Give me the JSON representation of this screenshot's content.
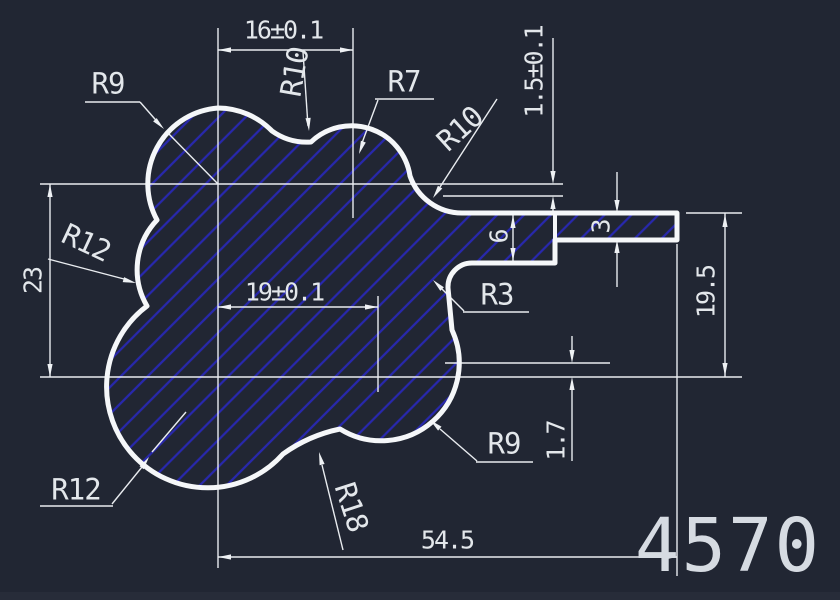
{
  "drawing": {
    "background_color": "#212633",
    "outline_color": "#f5f7f9",
    "dimension_line_color": "#e9ecf0",
    "hatch_color": "#2828ad",
    "text_color": "#e3e7eb"
  },
  "labels": {
    "dim_16": {
      "text": "16±0.1"
    },
    "r10_top": {
      "text": "R10"
    },
    "r9_top": {
      "text": "R9"
    },
    "r7": {
      "text": "R7"
    },
    "r10_right": {
      "text": "R10"
    },
    "dim_1_5": {
      "text": "1.5±0.1"
    },
    "r12_left": {
      "text": "R12"
    },
    "dim_23": {
      "text": "23"
    },
    "dim_19": {
      "text": "19±0.1"
    },
    "r3": {
      "text": "R3"
    },
    "dim_6": {
      "text": "6"
    },
    "dim_3": {
      "text": "3"
    },
    "dim_19_5": {
      "text": "19.5"
    },
    "r12_bottom": {
      "text": "R12"
    },
    "r18": {
      "text": "R18"
    },
    "r9_bottom": {
      "text": "R9"
    },
    "dim_1_7": {
      "text": "1.7"
    },
    "dim_54_5": {
      "text": "54.5"
    },
    "part_number": {
      "text": "4570"
    }
  }
}
